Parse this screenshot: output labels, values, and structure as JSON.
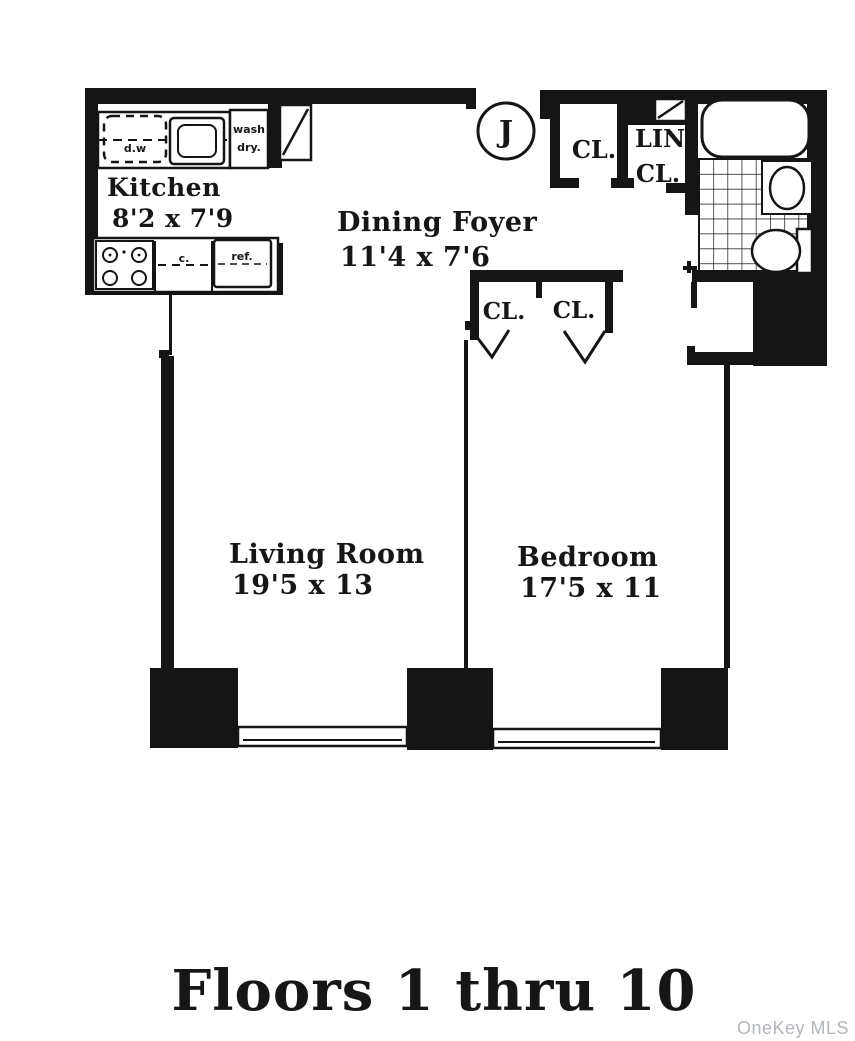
{
  "plan": {
    "unit_circle_label": "J",
    "rooms": {
      "kitchen": {
        "name": "Kitchen",
        "dims": "8'2 x 7'9"
      },
      "dining_foyer": {
        "name": "Dining Foyer",
        "dims": "11'4 x 7'6"
      },
      "living_room": {
        "name": "Living Room",
        "dims": "19'5 x 13"
      },
      "bedroom": {
        "name": "Bedroom",
        "dims": "17'5 x 11"
      }
    },
    "closets": {
      "hall_closet": "CL.",
      "linen_closet_line1": "LIN",
      "linen_closet_line2": "CL.",
      "bedroom_closet_left": "CL.",
      "bedroom_closet_right": "CL."
    },
    "kitchen_fixtures": {
      "dishwasher": "d.w",
      "washer": "wash",
      "dryer": "dry.",
      "counter": "c.",
      "refrigerator": "ref."
    },
    "caption": "Floors 1 thru 10",
    "watermark": "OneKey MLS",
    "colors": {
      "wall": "#151515",
      "background": "#ffffff",
      "watermark_gray": "#b2b6bb"
    }
  }
}
